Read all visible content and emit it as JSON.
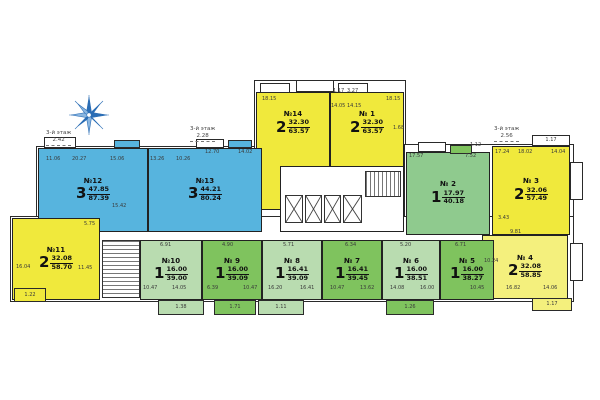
{
  "title": "Поэтажный план — 3-й этаж",
  "colors": {
    "blue": "#57b4de",
    "yellow": "#f0e93c",
    "lightYellow": "#f4f07d",
    "paleGreen": "#b9dcb0",
    "midGreen": "#7fc35e",
    "green2": "#8fca8e",
    "white": "#ffffff",
    "wall": "#222222",
    "compass": "#2a6db5"
  },
  "apartments": [
    {
      "number": "№ 1",
      "rooms": "2",
      "area_living": "32.30",
      "area_total": "63.57"
    },
    {
      "number": "№ 2",
      "rooms": "1",
      "area_living": "17.97",
      "area_total": "40.18"
    },
    {
      "number": "№ 3",
      "rooms": "2",
      "area_living": "32.06",
      "area_total": "57.49"
    },
    {
      "number": "№ 4",
      "rooms": "2",
      "area_living": "32.08",
      "area_total": "58.85"
    },
    {
      "number": "№ 5",
      "rooms": "1",
      "area_living": "16.00",
      "area_total": "38.27"
    },
    {
      "number": "№ 6",
      "rooms": "1",
      "area_living": "16.00",
      "area_total": "38.51"
    },
    {
      "number": "№ 7",
      "rooms": "1",
      "area_living": "16.41",
      "area_total": "39.45"
    },
    {
      "number": "№ 8",
      "rooms": "1",
      "area_living": "16.41",
      "area_total": "39.09"
    },
    {
      "number": "№ 9",
      "rooms": "1",
      "area_living": "16.00",
      "area_total": "39.09"
    },
    {
      "number": "№10",
      "rooms": "1",
      "area_living": "16.00",
      "area_total": "39.00"
    },
    {
      "number": "№11",
      "rooms": "2",
      "area_living": "32.08",
      "area_total": "58.70"
    },
    {
      "number": "№12",
      "rooms": "3",
      "area_living": "47.85",
      "area_total": "87.39"
    },
    {
      "number": "№13",
      "rooms": "3",
      "area_living": "44.21",
      "area_total": "80.24"
    },
    {
      "number": "№14",
      "rooms": "2",
      "area_living": "32.30",
      "area_total": "63.57"
    }
  ],
  "annotations": [
    {
      "text": "3-й этаж",
      "value": "2.42",
      "x": 46,
      "y": 130
    },
    {
      "text": "3-й этаж",
      "value": "2.28",
      "x": 190,
      "y": 126
    },
    {
      "text": "3-й этаж",
      "value": "2.56",
      "x": 494,
      "y": 126
    }
  ],
  "room_labels": [
    {
      "t": "11.06",
      "x": 46,
      "y": 157
    },
    {
      "t": "20.27",
      "x": 72,
      "y": 157
    },
    {
      "t": "15.06",
      "x": 110,
      "y": 157
    },
    {
      "t": "13.26",
      "x": 150,
      "y": 157
    },
    {
      "t": "10.26",
      "x": 176,
      "y": 157
    },
    {
      "t": "12.70",
      "x": 205,
      "y": 150
    },
    {
      "t": "14.02",
      "x": 238,
      "y": 150
    },
    {
      "t": "15.42",
      "x": 112,
      "y": 204
    },
    {
      "t": "18.15",
      "x": 262,
      "y": 97
    },
    {
      "t": "1.17",
      "x": 333,
      "y": 89
    },
    {
      "t": "3.27",
      "x": 347,
      "y": 89
    },
    {
      "t": "14.05",
      "x": 331,
      "y": 104
    },
    {
      "t": "14.15",
      "x": 347,
      "y": 104
    },
    {
      "t": "18.15",
      "x": 386,
      "y": 97
    },
    {
      "t": "1.68",
      "x": 393,
      "y": 126
    },
    {
      "t": "17.57",
      "x": 409,
      "y": 154
    },
    {
      "t": "7.52",
      "x": 465,
      "y": 154
    },
    {
      "t": "1.12",
      "x": 470,
      "y": 143
    },
    {
      "t": "17.24",
      "x": 495,
      "y": 150
    },
    {
      "t": "18.02",
      "x": 518,
      "y": 150
    },
    {
      "t": "14.04",
      "x": 551,
      "y": 150
    },
    {
      "t": "3.43",
      "x": 498,
      "y": 216
    },
    {
      "t": "9.81",
      "x": 510,
      "y": 230
    },
    {
      "t": "10.24",
      "x": 484,
      "y": 259
    },
    {
      "t": "16.82",
      "x": 506,
      "y": 286
    },
    {
      "t": "14.06",
      "x": 543,
      "y": 286
    },
    {
      "t": "5.75",
      "x": 84,
      "y": 222
    },
    {
      "t": "16.04",
      "x": 16,
      "y": 265
    },
    {
      "t": "11.45",
      "x": 78,
      "y": 266
    },
    {
      "t": "6.91",
      "x": 160,
      "y": 243
    },
    {
      "t": "4.90",
      "x": 222,
      "y": 243
    },
    {
      "t": "5.71",
      "x": 283,
      "y": 243
    },
    {
      "t": "6.34",
      "x": 345,
      "y": 243
    },
    {
      "t": "5.20",
      "x": 400,
      "y": 243
    },
    {
      "t": "6.71",
      "x": 455,
      "y": 243
    },
    {
      "t": "10.47",
      "x": 143,
      "y": 286
    },
    {
      "t": "14.05",
      "x": 172,
      "y": 286
    },
    {
      "t": "6.39",
      "x": 207,
      "y": 286
    },
    {
      "t": "10.47",
      "x": 243,
      "y": 286
    },
    {
      "t": "16.20",
      "x": 268,
      "y": 286
    },
    {
      "t": "16.41",
      "x": 300,
      "y": 286
    },
    {
      "t": "10.47",
      "x": 330,
      "y": 286
    },
    {
      "t": "13.62",
      "x": 360,
      "y": 286
    },
    {
      "t": "14.08",
      "x": 390,
      "y": 286
    },
    {
      "t": "16.00",
      "x": 420,
      "y": 286
    },
    {
      "t": "10.45",
      "x": 470,
      "y": 286
    }
  ],
  "balconies": [
    {
      "label": "1.38",
      "x": 158,
      "y": 300,
      "w": 46,
      "h": 15,
      "color": "paleGreen"
    },
    {
      "label": "1.71",
      "x": 214,
      "y": 300,
      "w": 42,
      "h": 15,
      "color": "midGreen"
    },
    {
      "label": "1.11",
      "x": 258,
      "y": 300,
      "w": 46,
      "h": 15,
      "color": "paleGreen"
    },
    {
      "label": "1.26",
      "x": 386,
      "y": 300,
      "w": 48,
      "h": 15,
      "color": "midGreen"
    },
    {
      "label": "1.22",
      "x": 14,
      "y": 288,
      "w": 32,
      "h": 14,
      "color": "yellow"
    },
    {
      "label": "1.17",
      "x": 532,
      "y": 298,
      "w": 40,
      "h": 13,
      "color": "lightYellow"
    },
    {
      "label": "1.17",
      "x": 532,
      "y": 135,
      "w": 38,
      "h": 11,
      "color": "white"
    },
    {
      "label": "",
      "x": 570,
      "y": 162,
      "w": 13,
      "h": 38,
      "color": "white"
    },
    {
      "label": "",
      "x": 570,
      "y": 243,
      "w": 13,
      "h": 38,
      "color": "white"
    },
    {
      "label": "",
      "x": 44,
      "y": 137,
      "w": 32,
      "h": 11,
      "color": "white"
    },
    {
      "label": "",
      "x": 114,
      "y": 140,
      "w": 26,
      "h": 8,
      "color": "blue"
    },
    {
      "label": "",
      "x": 228,
      "y": 140,
      "w": 24,
      "h": 8,
      "color": "blue"
    },
    {
      "label": "",
      "x": 196,
      "y": 139,
      "w": 28,
      "h": 9,
      "color": "white"
    },
    {
      "label": "",
      "x": 260,
      "y": 83,
      "w": 30,
      "h": 10,
      "color": "white"
    },
    {
      "label": "",
      "x": 296,
      "y": 80,
      "w": 38,
      "h": 12,
      "color": "white"
    },
    {
      "label": "",
      "x": 338,
      "y": 83,
      "w": 30,
      "h": 10,
      "color": "white"
    },
    {
      "label": "",
      "x": 418,
      "y": 142,
      "w": 28,
      "h": 10,
      "color": "white"
    },
    {
      "label": "",
      "x": 450,
      "y": 145,
      "w": 22,
      "h": 9,
      "color": "midGreen"
    }
  ]
}
